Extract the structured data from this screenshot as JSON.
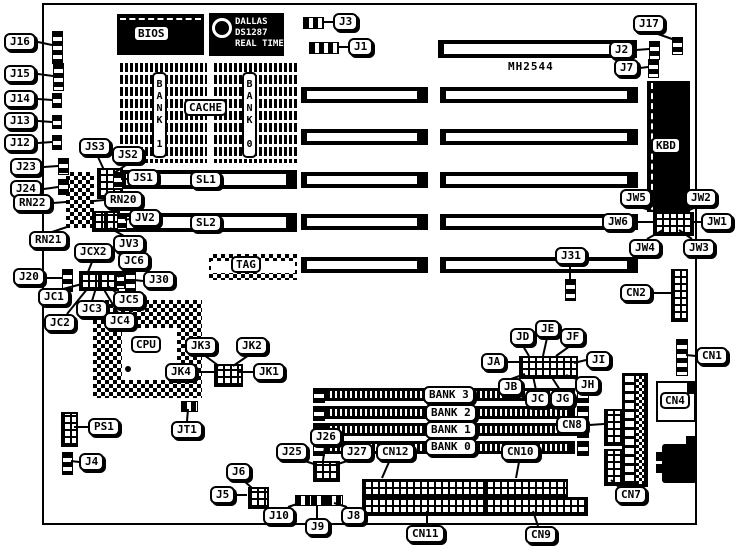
{
  "board": {
    "part_label": "MH2544"
  },
  "chips": {
    "bios": "BIOS",
    "rtc1": "DALLAS",
    "rtc2": "DS1287",
    "rtc3": "REAL TIME",
    "cache": "CACHE",
    "cache_bank_left": "BANK 1",
    "cache_bank_right": "BANK 0",
    "tag": "TAG",
    "kbd": "KBD",
    "cpu": "CPU"
  },
  "slot_labels": {
    "sl1": "SL1",
    "sl2": "SL2"
  },
  "simm_banks": {
    "bank3": "BANK 3",
    "bank2": "BANK 2",
    "bank1": "BANK 1",
    "bank0": "BANK 0"
  },
  "callouts": {
    "J1": "J1",
    "J2": "J2",
    "J3": "J3",
    "J4": "J4",
    "J5": "J5",
    "J6": "J6",
    "J7": "J7",
    "J8": "J8",
    "J9": "J9",
    "J10": "J10",
    "J12": "J12",
    "J13": "J13",
    "J14": "J14",
    "J15": "J15",
    "J16": "J16",
    "J17": "J17",
    "J20": "J20",
    "J23": "J23",
    "J24": "J24",
    "J25": "J25",
    "J26": "J26",
    "J27": "J27",
    "J30": "J30",
    "J31": "J31",
    "JS1": "JS1",
    "JS2": "JS2",
    "JS3": "JS3",
    "JV2": "JV2",
    "JV3": "JV3",
    "JCX2": "JCX2",
    "JC1": "JC1",
    "JC2": "JC2",
    "JC3": "JC3",
    "JC4": "JC4",
    "JC5": "JC5",
    "JC6": "JC6",
    "RN20": "RN20",
    "RN21": "RN21",
    "RN22": "RN22",
    "JK1": "JK1",
    "JK2": "JK2",
    "JK3": "JK3",
    "JK4": "JK4",
    "JT1": "JT1",
    "PS1": "PS1",
    "JW1": "JW1",
    "JW2": "JW2",
    "JW3": "JW3",
    "JW4": "JW4",
    "JW5": "JW5",
    "JW6": "JW6",
    "JA": "JA",
    "JB": "JB",
    "JC": "JC",
    "JD": "JD",
    "JE": "JE",
    "JF": "JF",
    "JG": "JG",
    "JH": "JH",
    "JI": "JI",
    "CN1": "CN1",
    "CN2": "CN2",
    "CN4": "CN4",
    "CN7": "CN7",
    "CN8": "CN8",
    "CN9": "CN9",
    "CN10": "CN10",
    "CN11": "CN11",
    "CN12": "CN12"
  }
}
